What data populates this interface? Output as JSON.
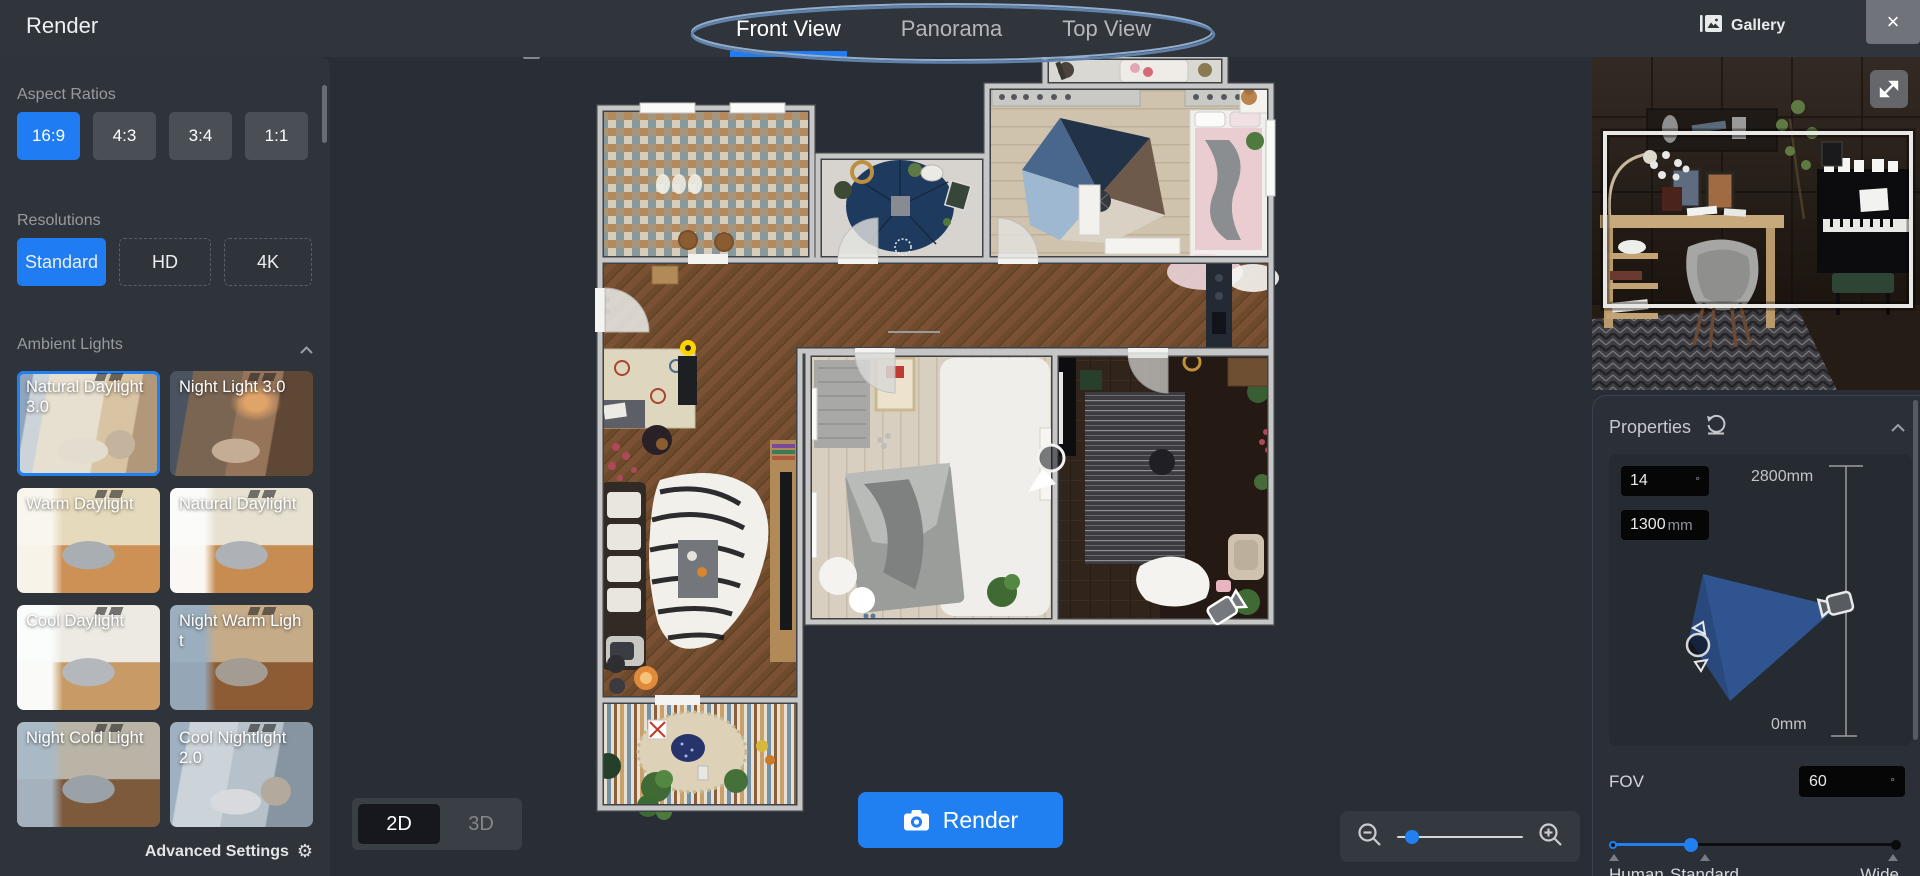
{
  "app": {
    "title": "Render"
  },
  "header": {
    "tabs": [
      {
        "label": "Front View",
        "active": true
      },
      {
        "label": "Panorama",
        "active": false
      },
      {
        "label": "Top View",
        "active": false
      }
    ],
    "gallery_label": "Gallery",
    "close_label": "×"
  },
  "sidebar": {
    "aspect_ratios": {
      "label": "Aspect Ratios",
      "options": [
        {
          "label": "16:9",
          "selected": true
        },
        {
          "label": "4:3",
          "selected": false
        },
        {
          "label": "3:4",
          "selected": false
        },
        {
          "label": "1:1",
          "selected": false
        }
      ]
    },
    "resolutions": {
      "label": "Resolutions",
      "options": [
        {
          "label": "Standard",
          "selected": true
        },
        {
          "label": "HD",
          "selected": false
        },
        {
          "label": "4K",
          "selected": false
        }
      ]
    },
    "ambient_lights": {
      "label": "Ambient Lights",
      "options": [
        {
          "label": "Natural Daylight 3.0",
          "selected": true,
          "scene": "living-day"
        },
        {
          "label": "Night Light 3.0",
          "selected": false,
          "scene": "living-night"
        },
        {
          "label": "Warm Daylight",
          "selected": false,
          "scene": "bed-warm"
        },
        {
          "label": "Natural Daylight",
          "selected": false,
          "scene": "bed-natural"
        },
        {
          "label": "Cool Daylight",
          "selected": false,
          "scene": "bed-cool"
        },
        {
          "label": "Night Warm Light",
          "selected": false,
          "scene": "bed-nightwarm"
        },
        {
          "label": "Night Cold Light",
          "selected": false,
          "scene": "bed-nightcold"
        },
        {
          "label": "Cool Nightlight 2.0",
          "selected": false,
          "scene": "living-coolnight"
        }
      ]
    },
    "advanced_settings_label": "Advanced Settings"
  },
  "canvas": {
    "view_toggle": {
      "options": [
        {
          "label": "2D",
          "active": true
        },
        {
          "label": "3D",
          "active": false
        }
      ]
    },
    "render_button_label": "Render"
  },
  "properties": {
    "title": "Properties",
    "pitch": {
      "value": "14",
      "unit": "°"
    },
    "height": {
      "value": "1300",
      "unit": "mm"
    },
    "height_max": "2800mm",
    "height_min": "0mm",
    "fov": {
      "label": "FOV",
      "value": "60",
      "unit": "°"
    },
    "fov_slider": {
      "labels": [
        "Human",
        "Standard",
        "Wide"
      ]
    }
  },
  "colors": {
    "accent_blue": "#1f7cf2",
    "render_button": "#2080f1",
    "tab_underline": "#1f7cf2",
    "selection_border": "#2080f1",
    "fov_cone": "#30548f",
    "camera_marker_yellow": "#ffd400"
  }
}
